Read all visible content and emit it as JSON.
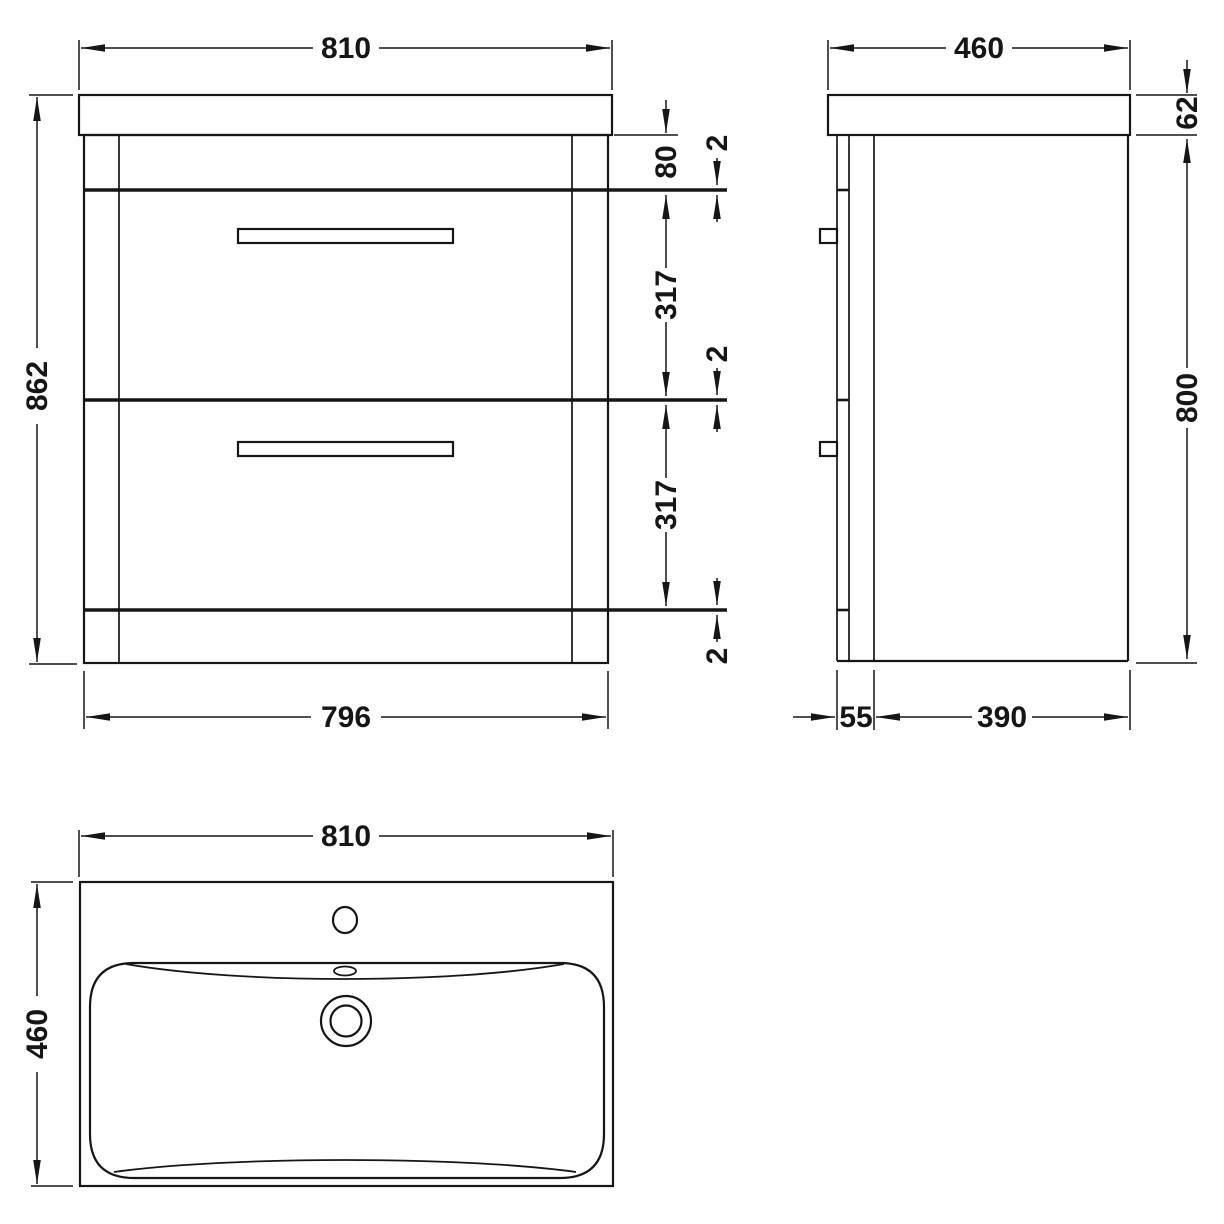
{
  "front": {
    "width_top": "810",
    "height_overall": "862",
    "width_bottom": "796",
    "rail_height": "80",
    "gap_top": "2",
    "drawer1_height": "317",
    "gap_middle": "2",
    "drawer2_height": "317",
    "gap_bottom": "2"
  },
  "side": {
    "depth_top": "460",
    "worktop_thickness": "62",
    "cabinet_height": "800",
    "drawer_front_depth": "55",
    "cabinet_depth": "390"
  },
  "plan": {
    "width": "810",
    "depth": "460"
  },
  "colors": {
    "line": "#161616",
    "background": "#ffffff"
  }
}
